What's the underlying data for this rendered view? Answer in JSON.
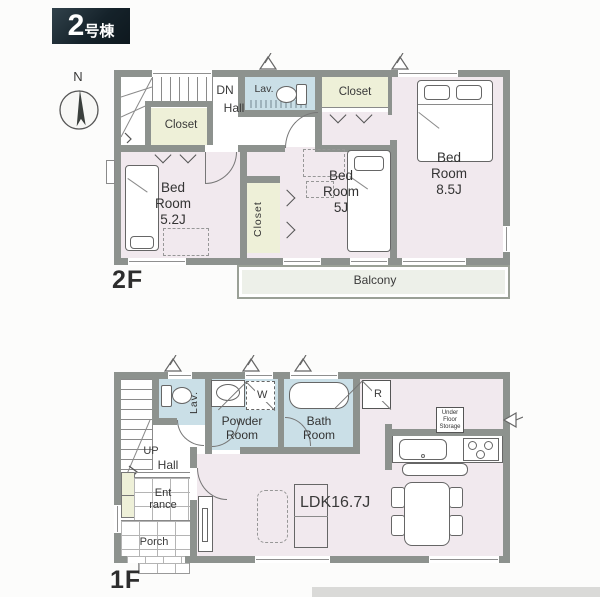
{
  "header": {
    "number": "2",
    "suffix": "号棟"
  },
  "compass": {
    "north": "N"
  },
  "f2": {
    "label": "2F",
    "dn": "DN",
    "hall": "Hall",
    "lav": "Lav.",
    "closet_a": "Closet",
    "closet_b": "Closet",
    "closet_c": "Closet",
    "bed85": {
      "l1": "Bed",
      "l2": "Room",
      "l3": "8.5J"
    },
    "bed52": {
      "l1": "Bed",
      "l2": "Room",
      "l3": "5.2J"
    },
    "bed5": {
      "l1": "Bed",
      "l2": "Room",
      "l3": "5J"
    },
    "balcony": "Balcony"
  },
  "f1": {
    "label": "1F",
    "up": "UP",
    "hall": "Hall",
    "lav": "Lav.",
    "powder": {
      "l1": "Powder",
      "l2": "Room"
    },
    "bath": {
      "l1": "Bath",
      "l2": "Room"
    },
    "washer": "W",
    "fridge": "R",
    "ufs": {
      "l1": "Under",
      "l2": "Floor",
      "l3": "Storage"
    },
    "ldk": "LDK16.7J",
    "entrance": {
      "l1": "Ent",
      "l2": "rance"
    },
    "porch": "Porch"
  },
  "colors": {
    "wall": "#8d928e",
    "room_pink": "#f1e9ee",
    "wet_blue": "#cadfe7",
    "closet_green": "#eef0d8",
    "balcony": "#edf0e9",
    "header_bg": "#15222a"
  }
}
